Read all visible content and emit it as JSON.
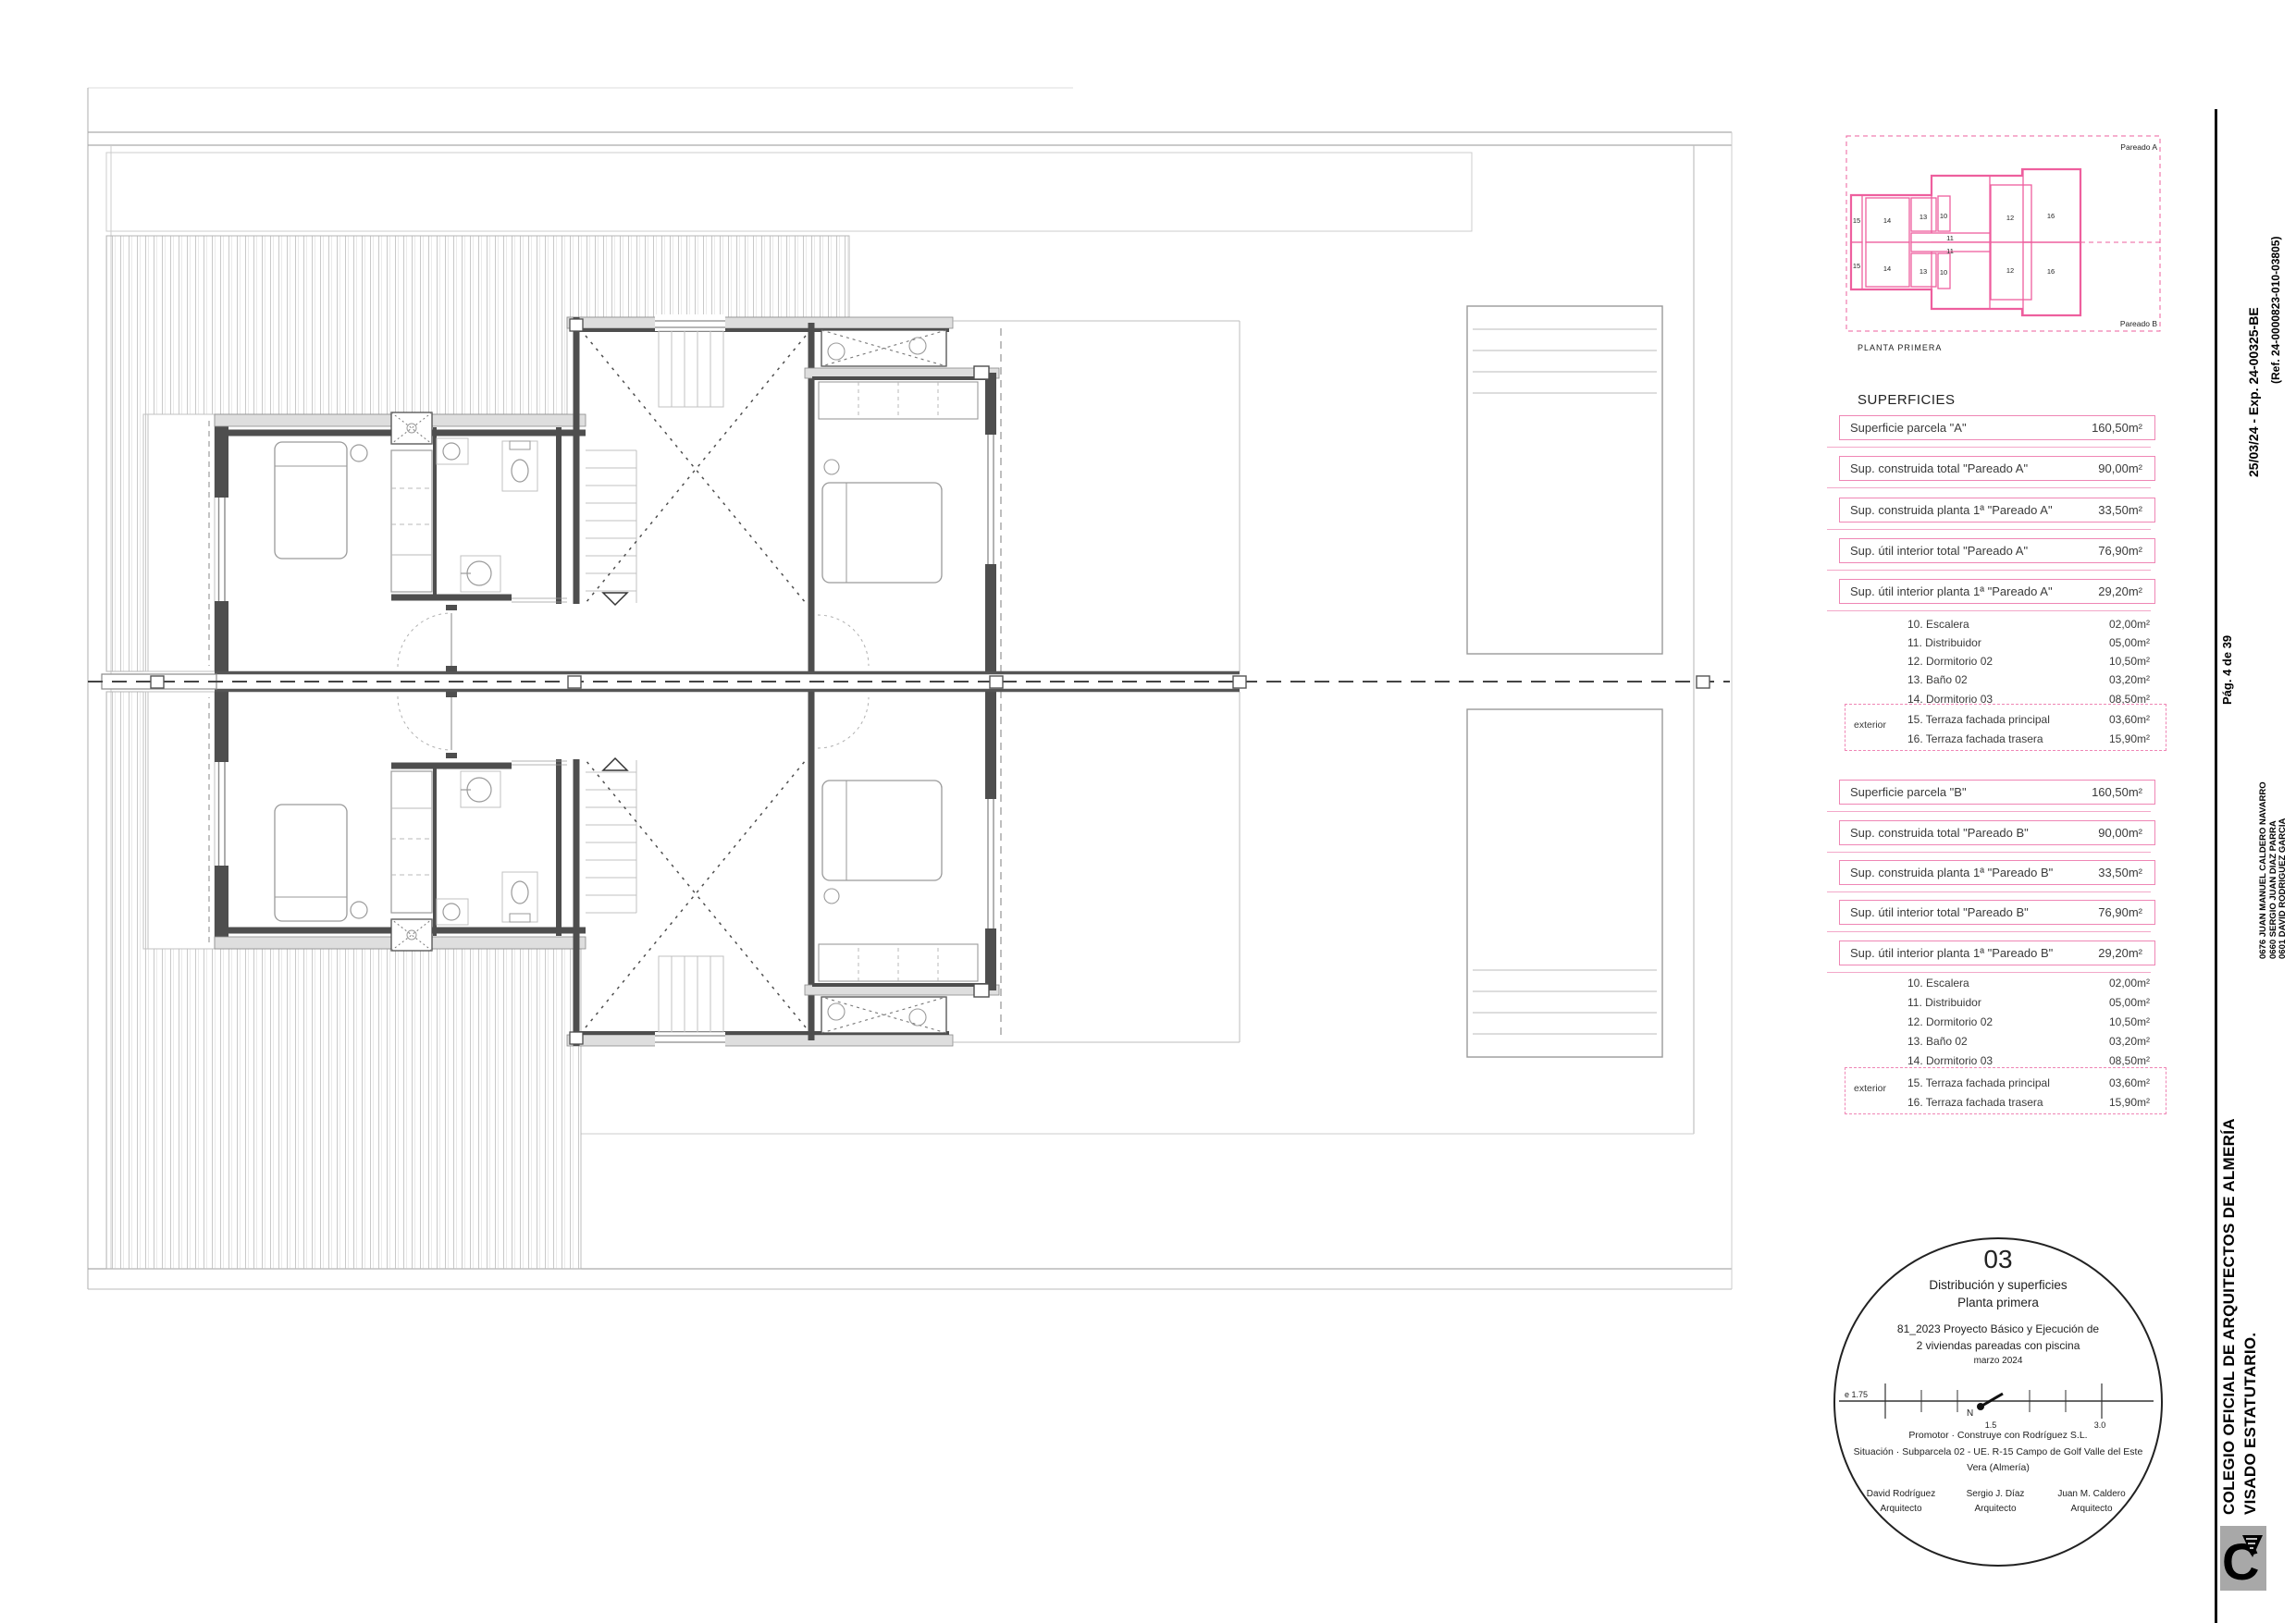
{
  "colors": {
    "accent_pink": "#ee5f9e",
    "table_pink": "#ef86b5",
    "wall_gray": "#4e4e4e",
    "line_gray": "#aaaaaa",
    "hatch_gray": "#c9c9c9",
    "stamp_border": "#222222",
    "logo_bg": "#a8a8a8"
  },
  "keyplan": {
    "unit_a_label": "Pareado A",
    "unit_b_label": "Pareado B",
    "caption": "PLANTA PRIMERA",
    "room_labels": [
      "15",
      "14",
      "13",
      "10",
      "11",
      "12",
      "16"
    ]
  },
  "superficies": {
    "heading": "SUPERFICIES",
    "section_a": {
      "boxes": [
        {
          "label": "Superficie parcela \"A\"",
          "value": "160,50m²"
        },
        {
          "label": "Sup. construida total \"Pareado A\"",
          "value": "90,00m²"
        },
        {
          "label": "Sup. construida planta 1ª \"Pareado A\"",
          "value": "33,50m²"
        },
        {
          "label": "Sup. útil interior total \"Pareado A\"",
          "value": "76,90m²"
        },
        {
          "label": "Sup. útil interior planta 1ª \"Pareado A\"",
          "value": "29,20m²"
        }
      ],
      "rooms": [
        {
          "label": "10. Escalera",
          "value": "02,00m²"
        },
        {
          "label": "11. Distribuidor",
          "value": "05,00m²"
        },
        {
          "label": "12. Dormitorio 02",
          "value": "10,50m²"
        },
        {
          "label": "13. Baño 02",
          "value": "03,20m²"
        },
        {
          "label": "14. Dormitorio 03",
          "value": "08,50m²"
        },
        {
          "label": "15. Terraza fachada principal",
          "value": "03,60m²"
        },
        {
          "label": "16. Terraza fachada trasera",
          "value": "15,90m²"
        }
      ],
      "exterior_label": "exterior"
    },
    "section_b": {
      "boxes": [
        {
          "label": "Superficie parcela \"B\"",
          "value": "160,50m²"
        },
        {
          "label": "Sup. construida total \"Pareado B\"",
          "value": "90,00m²"
        },
        {
          "label": "Sup. construida planta 1ª \"Pareado B\"",
          "value": "33,50m²"
        },
        {
          "label": "Sup. útil interior total \"Pareado B\"",
          "value": "76,90m²"
        },
        {
          "label": "Sup. útil interior planta 1ª \"Pareado B\"",
          "value": "29,20m²"
        }
      ],
      "rooms": [
        {
          "label": "10. Escalera",
          "value": "02,00m²"
        },
        {
          "label": "11. Distribuidor",
          "value": "05,00m²"
        },
        {
          "label": "12. Dormitorio 02",
          "value": "10,50m²"
        },
        {
          "label": "13. Baño 02",
          "value": "03,20m²"
        },
        {
          "label": "14. Dormitorio 03",
          "value": "08,50m²"
        },
        {
          "label": "15. Terraza fachada principal",
          "value": "03,60m²"
        },
        {
          "label": "16. Terraza fachada trasera",
          "value": "15,90m²"
        }
      ],
      "exterior_label": "exterior"
    }
  },
  "stamp": {
    "number": "03",
    "title_line1": "Distribución y superficies",
    "title_line2": "Planta primera",
    "project_line1": "81_2023 Proyecto Básico y Ejecución de",
    "project_line2": "2 viviendas pareadas con piscina",
    "date": "marzo 2024",
    "scale_label": "e 1.75",
    "north_label": "N",
    "tick_mid": "1.5",
    "tick_end": "3.0",
    "promotor": "Promotor · Construye con Rodríguez S.L.",
    "situacion_line1": "Situación · Subparcela 02 - UE. R-15 Campo de Golf Valle del Este",
    "situacion_line2": "Vera (Almería)",
    "architects": [
      {
        "name": "David Rodríguez",
        "role": "Arquitecto"
      },
      {
        "name": "Sergio J. Díaz",
        "role": "Arquitecto"
      },
      {
        "name": "Juan M. Caldero",
        "role": "Arquitecto"
      }
    ]
  },
  "sidebar": {
    "org_line1": "COLEGIO OFICIAL DE ARQUITECTOS DE ALMERÍA",
    "org_line2": "VISADO ESTATUTARIO.",
    "page_ref": "Pág. 4 de 39",
    "date_exp": "25/03/24  -  Exp. 24-00325-BE",
    "ref": "(Ref. 24-0000823-010-03805)",
    "architect_ids": [
      "0676 JUAN MANUEL CALDERO NAVARRO",
      "0660 SERGIO JUAN DIAZ PARRA",
      "0601 DAVID RODRIGUEZ GARCIA"
    ],
    "logo_letter": "C"
  }
}
